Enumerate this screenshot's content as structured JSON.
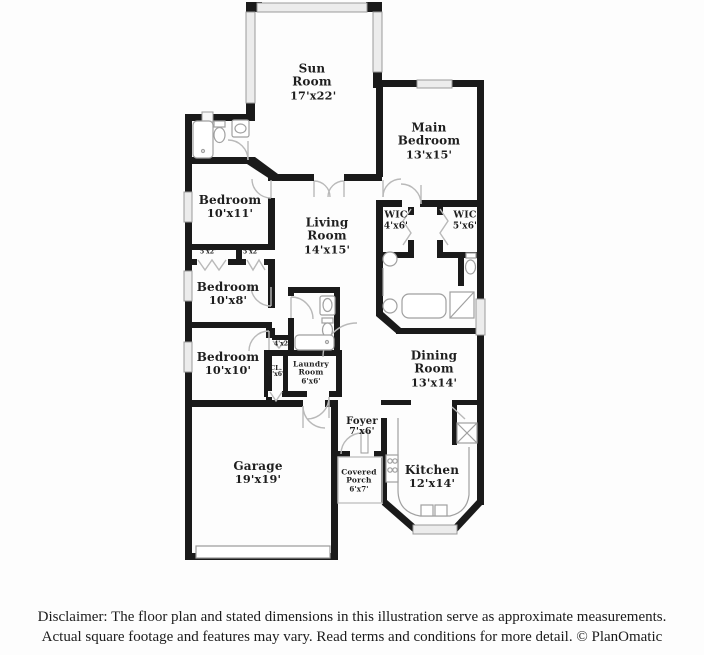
{
  "plan": {
    "colors": {
      "wall": "#1a1a1a",
      "window_fill": "#ececec",
      "window_stroke": "#9a9a9a",
      "door": "#b9b9b9",
      "fixture": "#a0a0a0",
      "label": "#1e1e1e"
    },
    "rooms": [
      {
        "name": "Sun Room",
        "dims": "17'x22'"
      },
      {
        "name": "Main Bedroom",
        "dims": "13'x15'"
      },
      {
        "name": "Bedroom",
        "dims": "10'x11'"
      },
      {
        "name": "Living Room",
        "dims": "14'x15'"
      },
      {
        "name": "WIC",
        "dims": "4'x6'"
      },
      {
        "name": "WIC",
        "dims": "5'x6'"
      },
      {
        "name": "",
        "dims": "5'x2'"
      },
      {
        "name": "",
        "dims": "5'x2'"
      },
      {
        "name": "Bedroom",
        "dims": "10'x8'"
      },
      {
        "name": "Bedroom",
        "dims": "10'x10'"
      },
      {
        "name": "",
        "dims": "4'x2'"
      },
      {
        "name": "CL.",
        "dims": "6'x6'"
      },
      {
        "name": "Laundry Room",
        "dims": "6'x6'"
      },
      {
        "name": "Dining Room",
        "dims": "13'x14'"
      },
      {
        "name": "Garage",
        "dims": "19'x19'"
      },
      {
        "name": "Foyer",
        "dims": "7'x6'"
      },
      {
        "name": "Covered Porch",
        "dims": "6'x7'"
      },
      {
        "name": "Kitchen",
        "dims": "12'x14'"
      }
    ]
  },
  "disclaimer": {
    "line1": "Disclaimer: The floor plan and stated dimensions in this illustration serve as approximate measurements.",
    "line2": "Actual square footage and features may vary. Read terms and conditions for more detail. © PlanOmatic"
  }
}
